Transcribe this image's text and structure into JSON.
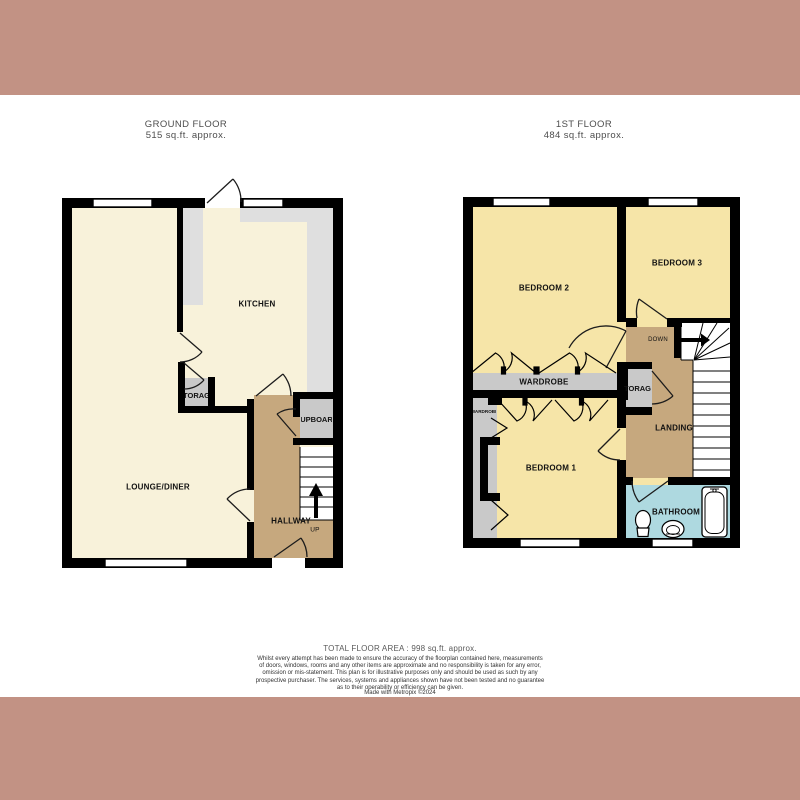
{
  "ground": {
    "title": "GROUND FLOOR",
    "area": "515 sq.ft. approx.",
    "rooms": {
      "kitchen": "KITCHEN",
      "lounge": "LOUNGE/DINER",
      "hallway": "HALLWAY",
      "storage": "STORAGE",
      "cupboard": "CUPBOARD"
    },
    "stairs_direction": "UP"
  },
  "first": {
    "title": "1ST FLOOR",
    "area": "484 sq.ft. approx.",
    "rooms": {
      "bedroom1": "BEDROOM 1",
      "bedroom2": "BEDROOM 2",
      "bedroom3": "BEDROOM 3",
      "wardrobe": "WARDROBE",
      "wardrobe_small": "WARDROBE",
      "storage": "STORAGE",
      "landing": "LANDING",
      "bathroom": "BATHROOM"
    },
    "stairs_direction": "DOWN"
  },
  "footer": {
    "total": "TOTAL FLOOR AREA : 998 sq.ft. approx.",
    "disclaimer_lines": [
      "Whilst every attempt has been made to ensure the accuracy of the floorplan contained here, measurements",
      "of doors, windows, rooms and any other items are approximate and no responsibility is taken for any error,",
      "omission or mis-statement. This plan is for illustrative purposes only and should be used as such by any",
      "prospective purchaser. The services, systems and appliances shown have not been tested and no guarantee",
      "as to their operability or efficiency can be given."
    ],
    "credit": "Made with Metropix ©2024"
  },
  "colors": {
    "band": "#c29284",
    "wall": "#000000",
    "floor_cream": "#f8f2da",
    "counter_gray": "#dfdfdf",
    "closet_gray": "#c9c9c9",
    "hall_tan": "#c6a87e",
    "bedroom_yellow": "#f6e5a8",
    "bathroom_blue": "#aed9e0"
  }
}
